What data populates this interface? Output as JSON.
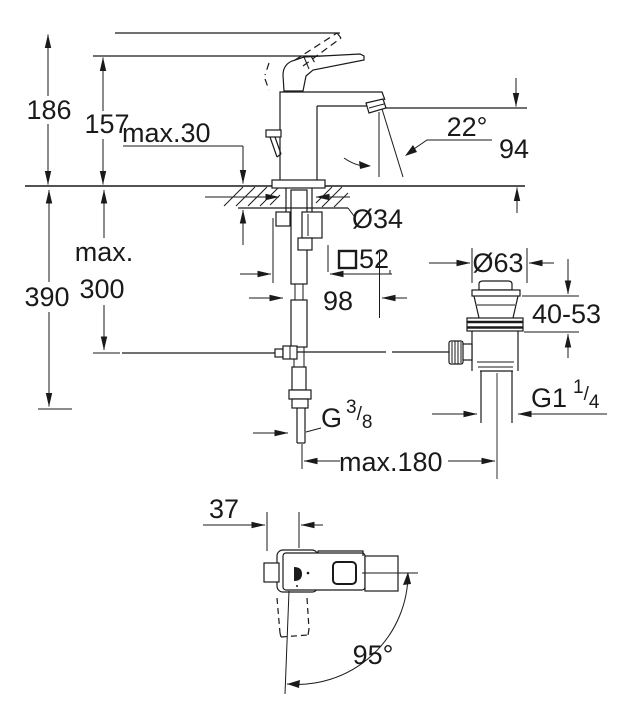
{
  "drawing": {
    "kind": "technical-dimension-drawing",
    "subject": "single-lever basin mixer with pop-up waste, front elevation and plan view",
    "line_color": "#1a1a1a",
    "background": "#ffffff"
  },
  "labels": {
    "overall_height": "186",
    "spout_ref_height": "157",
    "deck_thickness": "max.30",
    "stream_angle": "22°",
    "spout_outlet_height": "94",
    "hole_diameter": "Ø34",
    "max_prefix": "max.",
    "hose_length": "390",
    "rod_depth": "300",
    "base_square_value": "52",
    "spout_reach": "98",
    "waste_flange_diameter": "Ø63",
    "clamping_range": "40-53",
    "rod_reach": "max.180",
    "plan_offset": "37",
    "handle_swing": "95°",
    "supply_thread": {
      "main": "G",
      "sup": "3",
      "slash": "/",
      "sub": "8"
    },
    "waste_thread": {
      "main": "G1",
      "sup": "1",
      "slash": "/",
      "sub": "4"
    }
  }
}
